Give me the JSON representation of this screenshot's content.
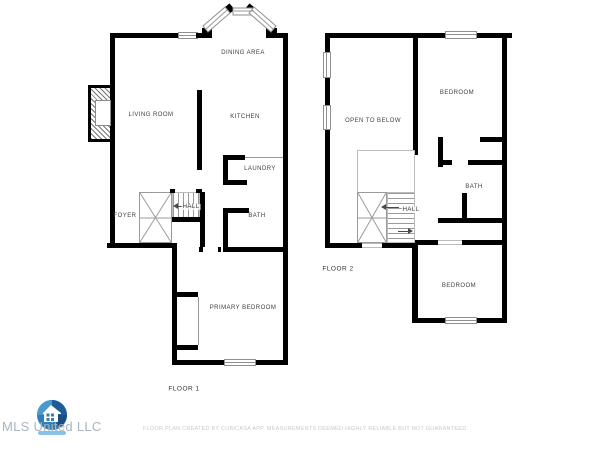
{
  "floor1": {
    "label": "FLOOR 1",
    "rooms": {
      "dining_area": "DINING AREA",
      "living_room": "LIVING ROOM",
      "kitchen": "KITCHEN",
      "laundry": "LAUNDRY",
      "bath": "BATH",
      "foyer": "FOYER",
      "hall": "HALL",
      "primary_bedroom": "PRIMARY BEDROOM"
    }
  },
  "floor2": {
    "label": "FLOOR 2",
    "rooms": {
      "open_to_below": "OPEN TO BELOW",
      "bedroom_upper": "BEDROOM",
      "bath": "BATH",
      "hall": "HALL",
      "bedroom_lower": "BEDROOM"
    }
  },
  "watermark": {
    "company": "MLS United LLC",
    "logo_icon": "house-in-blue-circle"
  },
  "footer": {
    "disclaimer": "FLOOR PLAN CREATED BY CUBICASA APP. MEASUREMENTS DEEMED HIGHLY RELIABLE BUT NOT GUARANTEED."
  },
  "colors": {
    "wall": "#000000",
    "room_label": "#404040",
    "floor_label": "#333333",
    "watermark_text": "#a9b4bd",
    "disclaimer_text": "#c6c9cb",
    "logo_blue": "#2d7fc0",
    "logo_dark_blue": "#1d5c97",
    "logo_light_blue": "#4a9ad0"
  }
}
